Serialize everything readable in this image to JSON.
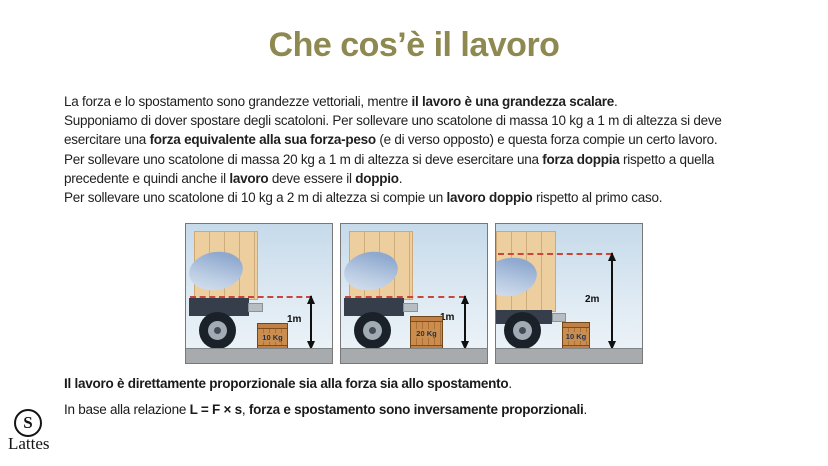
{
  "title": {
    "text": "Che cos’è il lavoro",
    "color": "#8e8950"
  },
  "body": {
    "lines": [
      [
        {
          "t": "La forza e lo spostamento sono grandezze vettoriali, mentre "
        },
        {
          "t": "il lavoro è una grandezza scalare",
          "b": true
        },
        {
          "t": "."
        }
      ],
      [
        {
          "t": "Supponiamo di dover spostare degli scatoloni. Per sollevare uno scatolone di massa 10 kg a 1 m di altezza si deve"
        }
      ],
      [
        {
          "t": "esercitare una "
        },
        {
          "t": "forza equivalente alla sua forza-peso",
          "b": true
        },
        {
          "t": " (e di verso opposto) e questa forza compie un certo lavoro."
        }
      ],
      [
        {
          "t": "Per sollevare uno scatolone di massa 20 kg a 1 m di altezza si deve esercitare una "
        },
        {
          "t": "forza doppia",
          "b": true
        },
        {
          "t": " rispetto a quella"
        }
      ],
      [
        {
          "t": "precedente e quindi anche il "
        },
        {
          "t": "lavoro",
          "b": true
        },
        {
          "t": " deve essere il "
        },
        {
          "t": "doppio",
          "b": true
        },
        {
          "t": "."
        }
      ],
      [
        {
          "t": "Per sollevare uno scatolone di 10 kg a 2 m di altezza si compie un "
        },
        {
          "t": "lavoro doppio",
          "b": true
        },
        {
          "t": " rispetto al primo caso."
        }
      ]
    ]
  },
  "figures": [
    {
      "crate_label": "10 Kg",
      "height_label": "1m"
    },
    {
      "crate_label": "20 Kg",
      "height_label": "1m"
    },
    {
      "crate_label": "10 Kg",
      "height_label": "2m"
    }
  ],
  "statements": {
    "lines": [
      [
        {
          "t": "Il lavoro è direttamente proporzionale sia alla forza sia allo spostamento",
          "b": true
        },
        {
          "t": "."
        }
      ],
      [
        {
          "t": "In base alla relazione "
        },
        {
          "t": "L = F × s",
          "b": true
        },
        {
          "t": ", "
        },
        {
          "t": "forza e spostamento sono inversamente proporzionali",
          "b": true
        },
        {
          "t": "."
        }
      ]
    ]
  },
  "logo": {
    "mark": "S",
    "name": "Lattes"
  },
  "colors": {
    "title_gold": "#8e8950",
    "text": "#1f1f1f",
    "sky": "#c6daea",
    "ground": "#a8abae",
    "cargo_tan": "#ecce9f",
    "crate_wood": "#cc8c4c",
    "dotted_line_red": "#c8473a",
    "arrow_black": "#101010"
  }
}
